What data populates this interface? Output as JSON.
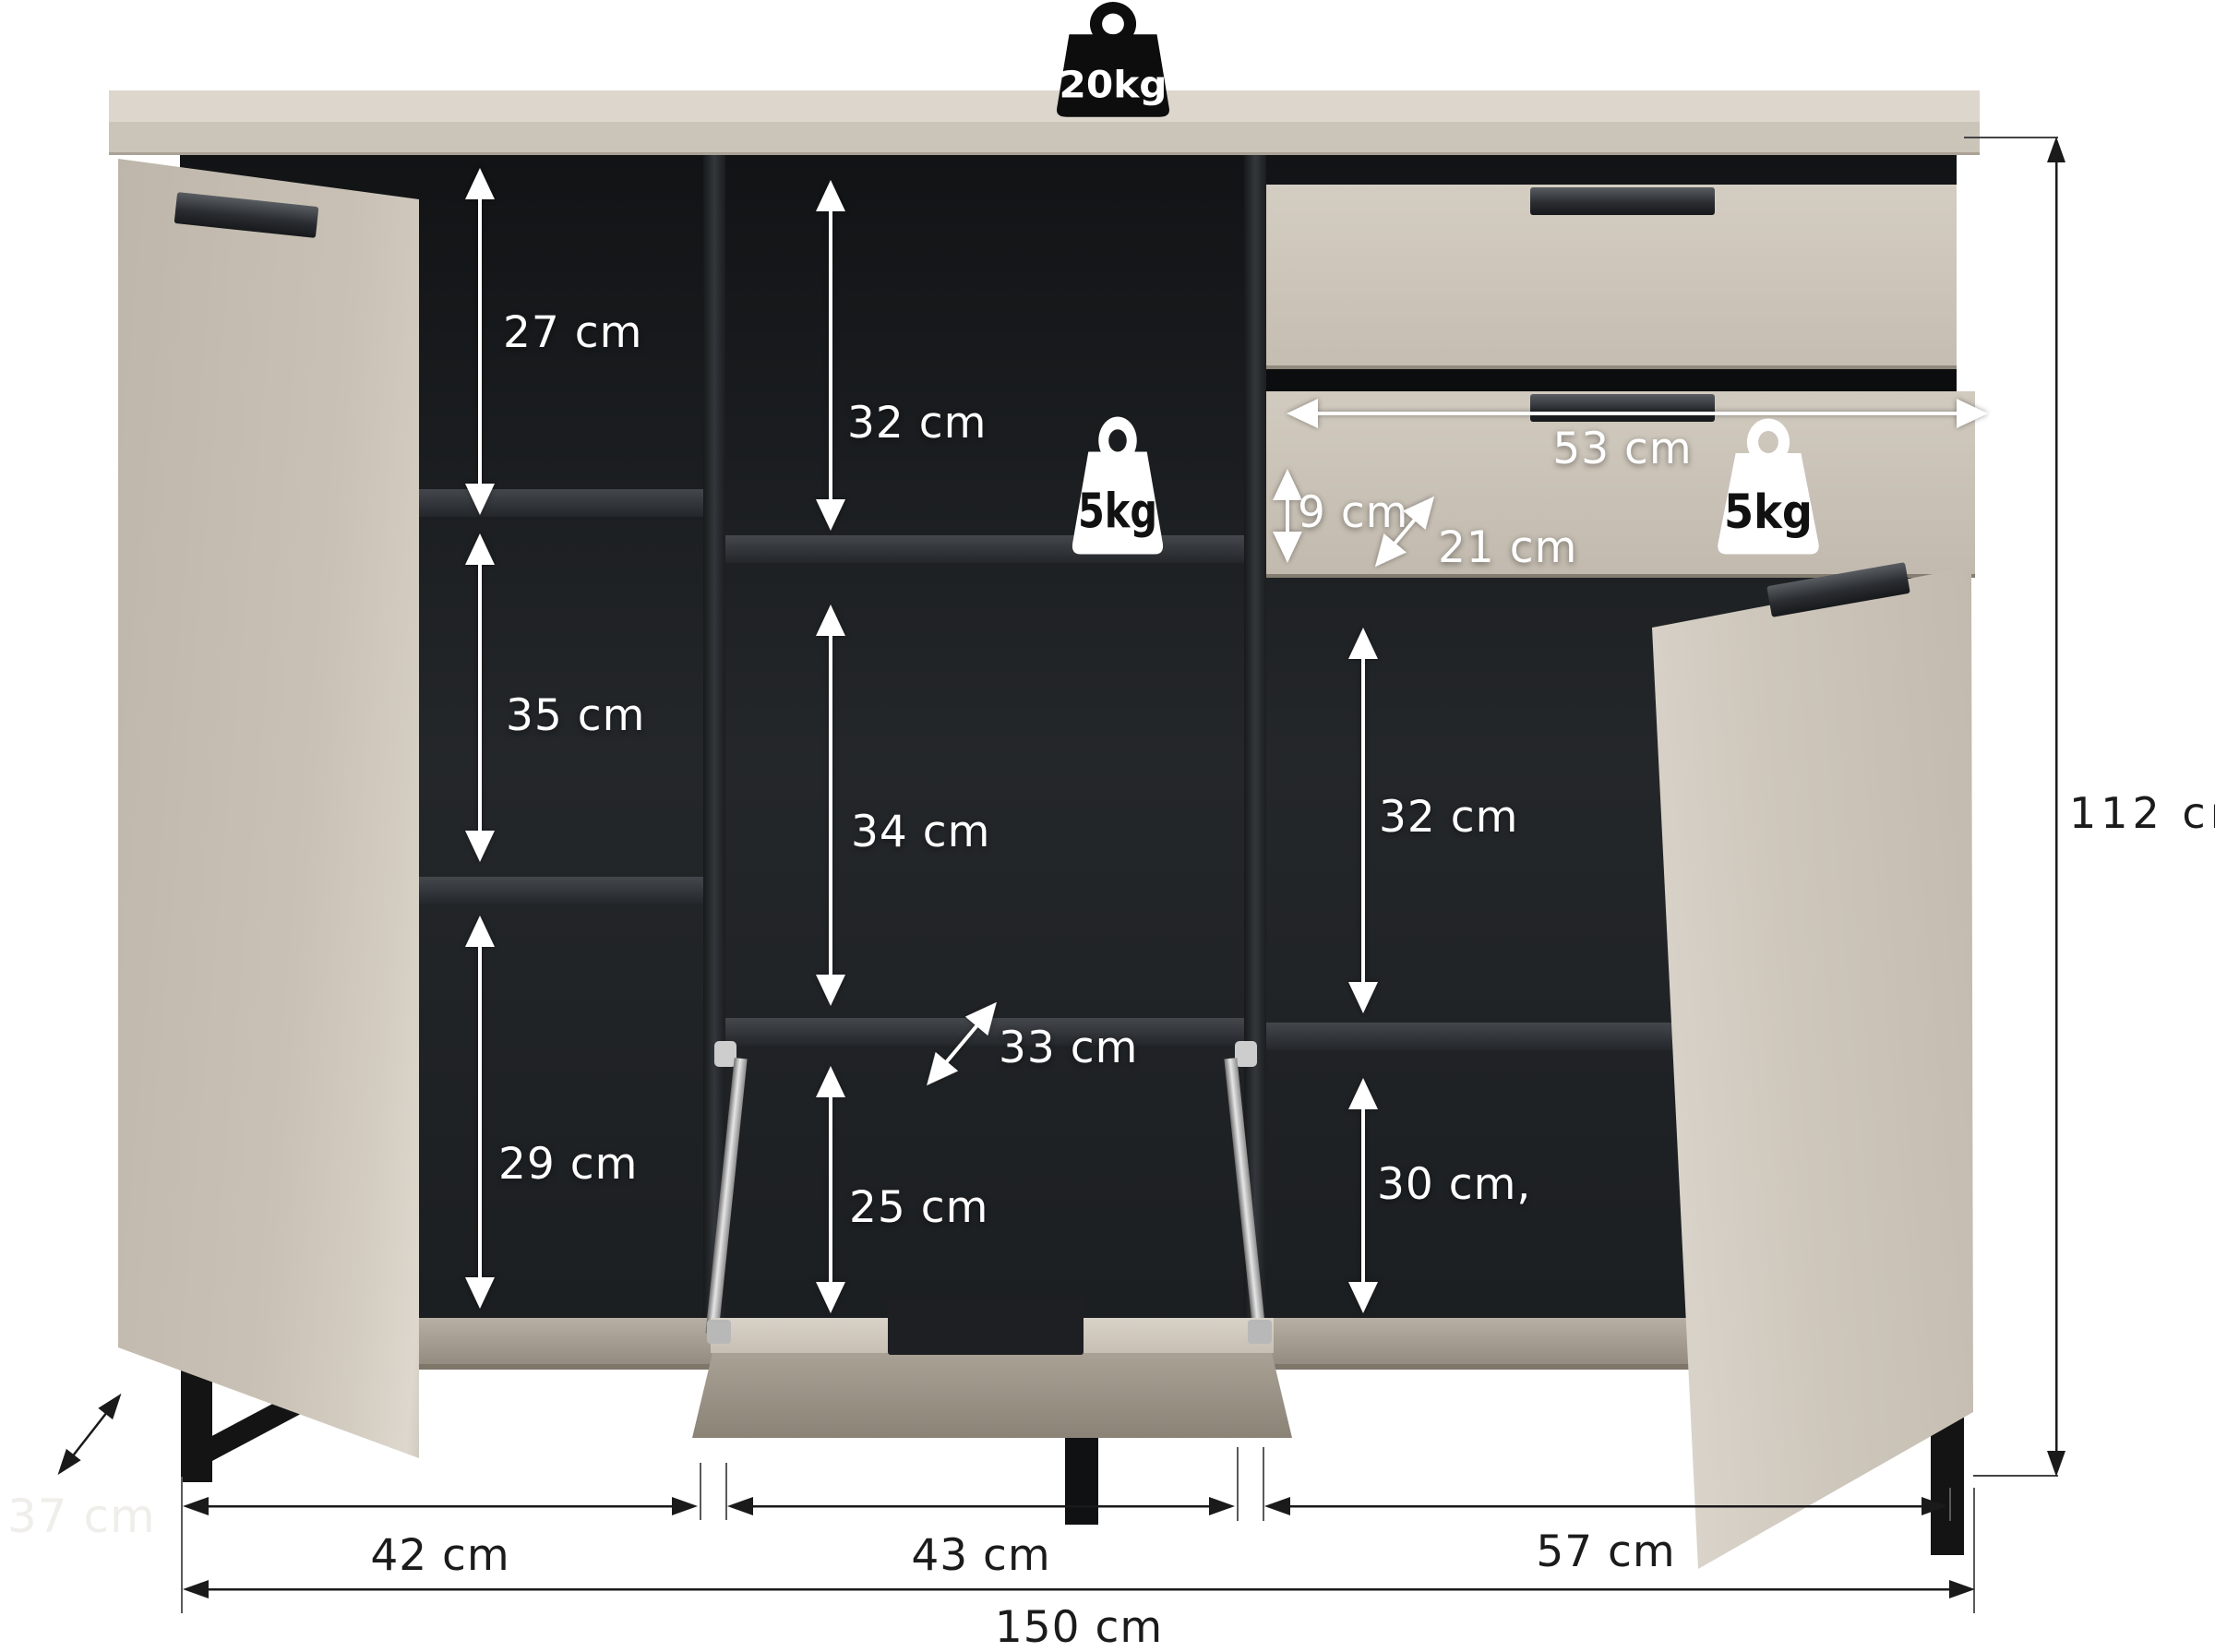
{
  "title": "sideboard-dimension-diagram",
  "colors": {
    "background": "#ffffff",
    "body_beige": "#c9c1b5",
    "body_light": "#dcd6cc",
    "interior_black": "#1d2023",
    "metal_black": "#141414",
    "label_light": "#ffffff",
    "label_dark": "#1b1b1b"
  },
  "weights": {
    "top": "20kg",
    "shelf": "5kg",
    "drawer": "5kg"
  },
  "compartments": {
    "left": {
      "top": "27 cm",
      "middle": "35 cm",
      "bottom": "29 cm"
    },
    "center": {
      "top": "32 cm",
      "middle": "34 cm",
      "depth": "33 cm",
      "bottom": "25 cm"
    },
    "right": {
      "top": "32 cm",
      "bottom": "30 cm,"
    }
  },
  "drawer": {
    "width": "53 cm",
    "front_height": "9 cm",
    "depth": "21 cm"
  },
  "overall": {
    "height": "112 cm",
    "width": "150 cm",
    "depth": "37 cm",
    "section_left": "42 cm",
    "section_center": "43 cm",
    "section_right": "57 cm"
  }
}
